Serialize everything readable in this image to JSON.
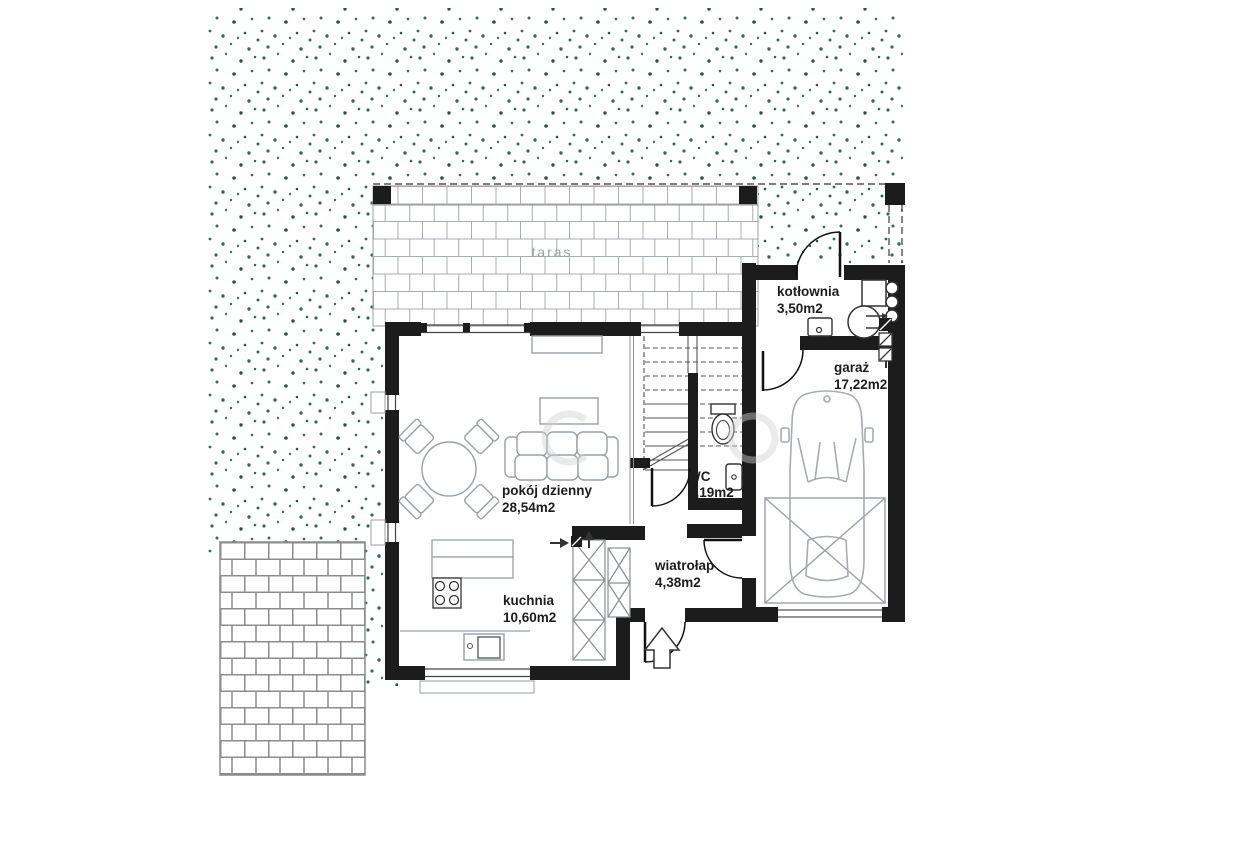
{
  "floorplan": {
    "rooms": [
      {
        "id": "taras",
        "label": "taras",
        "area": ""
      },
      {
        "id": "kotlownia",
        "label": "kotłownia",
        "area": "3,50m2"
      },
      {
        "id": "garaz",
        "label": "garaż",
        "area": "17,22m2"
      },
      {
        "id": "pokoj-dzienny",
        "label": "pokój dzienny",
        "area": "28,54m2"
      },
      {
        "id": "wc",
        "label": "WC",
        "area": "2,19m2"
      },
      {
        "id": "wiatrolap",
        "label": "wiatrołap",
        "area": "4,38m2"
      },
      {
        "id": "kuchnia",
        "label": "kuchnia",
        "area": "10,60m2"
      }
    ],
    "colors": {
      "wall": "#1c1c1c",
      "furniture_line": "#9aa0a6",
      "tile_line": "#a9aeb4",
      "brick_line": "#8c8c8c",
      "speckle_green": "#2f6e52",
      "label": "#1d1d1d",
      "taras_label": "#9aa0a6"
    },
    "watermark_present": true
  }
}
